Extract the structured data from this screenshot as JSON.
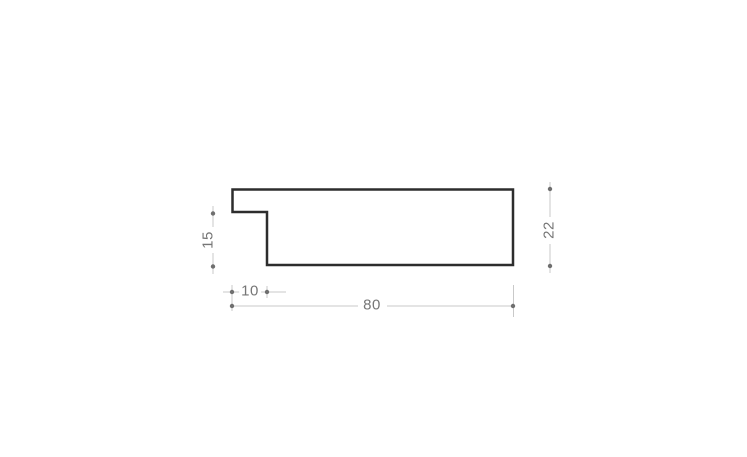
{
  "canvas": {
    "background_color": "#ffffff"
  },
  "drawing": {
    "description": "frame-moulding-profile-cross-section",
    "outline_color": "#2d2d2d",
    "fill_color": "#ffffff",
    "dim_line_color": "#c9c9c9",
    "dim_marker_color": "#6f6f6f",
    "dim_text_color": "#767676",
    "dimensions": [
      {
        "id": "rabbet-height",
        "label": "15",
        "value": 15,
        "orientation": "vertical",
        "position": "left-of-profile"
      },
      {
        "id": "overall-height",
        "label": "22",
        "value": 22,
        "orientation": "vertical",
        "position": "right-of-profile"
      },
      {
        "id": "rabbet-width",
        "label": "10",
        "value": 10,
        "orientation": "horizontal",
        "position": "below-profile-left"
      },
      {
        "id": "overall-width",
        "label": "80",
        "value": 80,
        "orientation": "horizontal",
        "position": "below-profile"
      }
    ]
  }
}
